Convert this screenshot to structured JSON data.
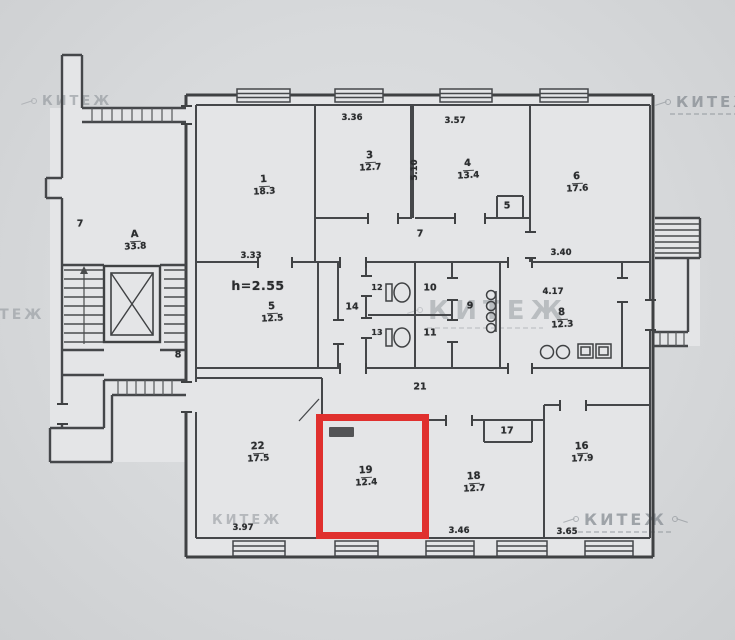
{
  "watermark": {
    "text": "КИТЕЖ"
  },
  "colors": {
    "highlight": "#e0302e",
    "wall": "#3f4143",
    "paper": "#e4e5e7",
    "background": "#d7d9db",
    "label": "#2b2d2f",
    "watermark": "#878d93"
  },
  "plan": {
    "notes": {
      "ceiling": "h=2.55"
    },
    "stairwell": {
      "letter": "А",
      "area": "33.8"
    },
    "rooms": [
      {
        "number": "1",
        "area": "18.3"
      },
      {
        "number": "3",
        "area": "12.7"
      },
      {
        "number": "4",
        "area": "13.4"
      },
      {
        "number": "6",
        "area": "17.6"
      },
      {
        "number": "5",
        "area": "12.5"
      },
      {
        "number": "8",
        "area": "12.3"
      },
      {
        "number": "22",
        "area": "17.5"
      },
      {
        "number": "19",
        "area": "12.4",
        "highlighted": true
      },
      {
        "number": "18",
        "area": "12.7"
      },
      {
        "number": "16",
        "area": "17.9"
      }
    ],
    "small_labels": {
      "corridor_left": "7",
      "corridor_main": "7",
      "vestibule": "8",
      "corridor_mid": "14",
      "bathroom": "9",
      "storage_top": "10",
      "storage_bottom": "11",
      "wc_top": "12",
      "wc_bottom": "13",
      "corridor_bottom": "21",
      "niche_closet": "17",
      "closet_top": "5"
    },
    "dimensions": {
      "room1": "3.33",
      "room3": "3.36",
      "room4": "3.57",
      "room6": "3.40",
      "kitchen": "4.17",
      "room22": "3.97",
      "room18": "3.46",
      "room16": "3.65",
      "vertical": "5.10"
    }
  }
}
